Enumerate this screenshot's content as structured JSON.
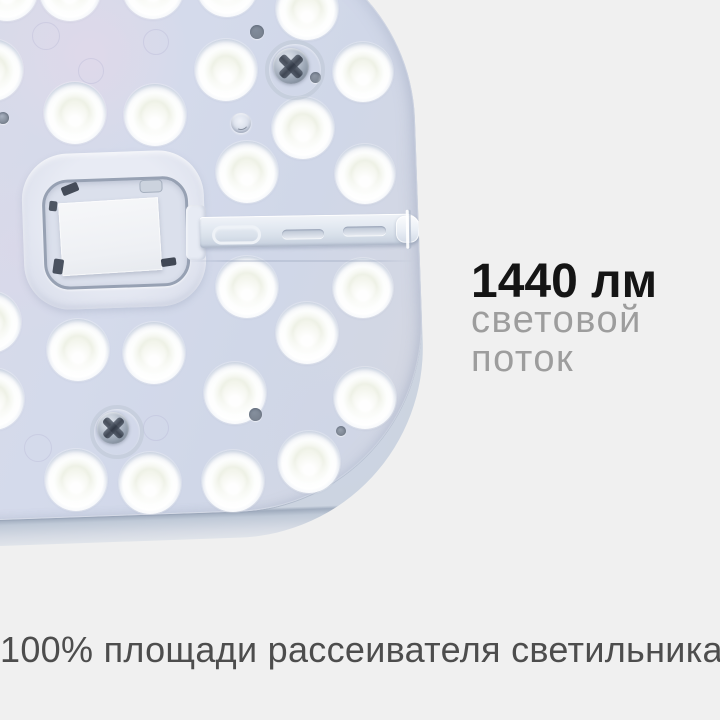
{
  "page_background": "#f0f0f0",
  "headline": {
    "text": "1440 лм",
    "color": "#151515"
  },
  "subheadline": {
    "line1": "световой",
    "line2": "поток",
    "color": "#9d9d9d"
  },
  "caption": {
    "text": "100% площади рассеивателя светильника",
    "color": "#4d4d4d"
  },
  "product": {
    "description": "round-corner LED light module, top view, right half visible",
    "colors": {
      "panel_face": "#d6daea",
      "panel_edge_band": "#c3ccda",
      "lens_white": "#ffffff",
      "lens_center": "#eef1e6",
      "metal": "#8b96a5",
      "label": "#f2f4f7"
    },
    "leds": [
      {
        "x": 7,
        "y": -10,
        "r": 31
      },
      {
        "x": 70,
        "y": -10,
        "r": 31
      },
      {
        "x": 153,
        "y": -12,
        "r": 31
      },
      {
        "x": 227,
        "y": -14,
        "r": 31
      },
      {
        "x": 307,
        "y": 9,
        "r": 31
      },
      {
        "x": 363,
        "y": 72,
        "r": 30
      },
      {
        "x": -8,
        "y": 70,
        "r": 31
      },
      {
        "x": 226,
        "y": 70,
        "r": 31
      },
      {
        "x": 303,
        "y": 128,
        "r": 31
      },
      {
        "x": 75,
        "y": 113,
        "r": 31
      },
      {
        "x": 155,
        "y": 115,
        "r": 31
      },
      {
        "x": 247,
        "y": 172,
        "r": 31
      },
      {
        "x": 365,
        "y": 174,
        "r": 30
      },
      {
        "x": 247,
        "y": 287,
        "r": 31
      },
      {
        "x": 363,
        "y": 288,
        "r": 30
      },
      {
        "x": -10,
        "y": 322,
        "r": 31
      },
      {
        "x": 307,
        "y": 333,
        "r": 31
      },
      {
        "x": 78,
        "y": 350,
        "r": 31
      },
      {
        "x": 154,
        "y": 353,
        "r": 31
      },
      {
        "x": 235,
        "y": 393,
        "r": 31
      },
      {
        "x": 365,
        "y": 398,
        "r": 31
      },
      {
        "x": -7,
        "y": 399,
        "r": 31
      },
      {
        "x": 309,
        "y": 462,
        "r": 31
      },
      {
        "x": 76,
        "y": 480,
        "r": 31
      },
      {
        "x": 150,
        "y": 483,
        "r": 31
      },
      {
        "x": 233,
        "y": 481,
        "r": 31
      }
    ],
    "screws": [
      {
        "x": 291,
        "y": 66,
        "r": 18,
        "ring": 26
      },
      {
        "x": 113,
        "y": 428,
        "r": 16,
        "ring": 23
      }
    ],
    "holes": [
      {
        "x": 257,
        "y": 32,
        "r": 7,
        "c": "#828c9b"
      },
      {
        "x": 315,
        "y": 77,
        "r": 5.5,
        "c": "#8d96a4"
      },
      {
        "x": 255,
        "y": 414,
        "r": 6.5,
        "c": "#858f9d"
      },
      {
        "x": 341,
        "y": 431,
        "r": 5,
        "c": "#98a1ae"
      },
      {
        "x": 3,
        "y": 118,
        "r": 6,
        "c": "#a8b1c0"
      }
    ],
    "mold_rings": [
      {
        "x": 45,
        "y": 35,
        "r": 13
      },
      {
        "x": 155,
        "y": 41,
        "r": 12
      },
      {
        "x": 90,
        "y": 70,
        "r": 12
      },
      {
        "x": 37,
        "y": 447,
        "r": 13
      },
      {
        "x": 155,
        "y": 427,
        "r": 12
      }
    ],
    "tints": [
      {
        "x": 90,
        "y": 55,
        "r": 100,
        "color": "rgba(230,216,234,0.55)"
      },
      {
        "x": 18,
        "y": 250,
        "r": 90,
        "color": "rgba(222,214,232,0.4)"
      },
      {
        "x": 330,
        "y": 430,
        "r": 90,
        "color": "rgba(203,213,233,0.45)"
      }
    ],
    "glue_dot": {
      "x": 241,
      "y": 123,
      "r": 10
    }
  }
}
